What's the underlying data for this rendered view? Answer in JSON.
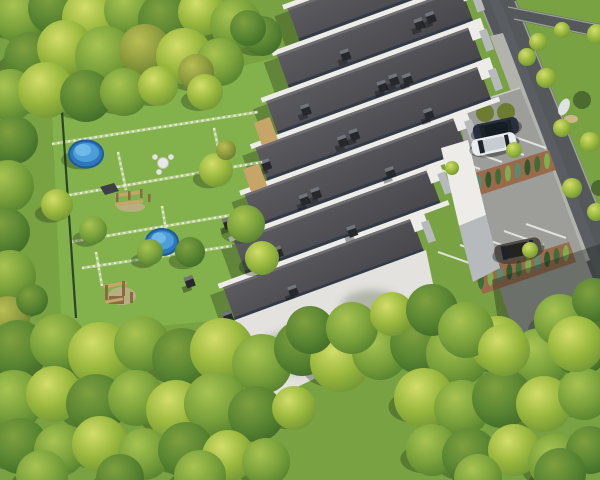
{
  "scene": {
    "type": "aerial-3d-architectural-render",
    "description": "Bird's-eye 3D visualization of a terraced housing development: seven staggered row-house units with dark flat roofs and white parapet walls descending diagonally, private gardens with white fences, two round above-ground pools, two wooden playgrounds, a diagonal asphalt road on the right with sidewalk and parking bays holding three cars, hedge planters between parking rows, surrounded by dense green tree canopy.",
    "counts": {
      "roof_rows": 7,
      "pools": 2,
      "playgrounds": 2,
      "cars": 3,
      "hedge_planters": 2,
      "roads": 2
    }
  },
  "colors": {
    "grass_base": "#79a342",
    "lawn": "#83b14c",
    "shadow": "rgba(24,42,18,0.32)",
    "road_asphalt": "#55585b",
    "road_lane": "#5e6165",
    "road_edge": "#9fa19b",
    "sidewalk": "#b2b3ac",
    "parking": "#9d9e9a",
    "parking_shadow": "rgba(28,36,30,0.38)",
    "stall_line": "#e8e9e4",
    "mulch": "#9a6a4b",
    "roof_parapet": "#333b48",
    "wall_white": "#edece8",
    "wall_shadow": "#b7babd",
    "facade": "#e3e2de",
    "chimney": "#26282c",
    "chimney_cap": "#72767c",
    "pool_rim": "#1d5b9a",
    "pool_wall": "#2f77bd",
    "pool_water": "#4c9ed8",
    "pool_light": "#79c2ec",
    "wood": "#c7a468",
    "wood_dark": "#8a6a45",
    "fence_white": "#e9ecd9",
    "fence_dark": "#2c4527",
    "hedge_ball": "#6d7c30",
    "sand": "#c2b089"
  },
  "scene_objects": {
    "trees": [
      [
        20,
        15,
        28,
        2
      ],
      [
        55,
        8,
        27,
        3
      ],
      [
        92,
        18,
        30,
        1
      ],
      [
        130,
        10,
        26,
        2
      ],
      [
        166,
        20,
        28,
        3
      ],
      [
        202,
        12,
        24,
        1
      ],
      [
        236,
        24,
        26,
        2
      ],
      [
        262,
        36,
        20,
        3
      ],
      [
        248,
        28,
        18,
        3
      ],
      [
        30,
        58,
        26,
        3
      ],
      [
        65,
        48,
        28,
        1
      ],
      [
        105,
        56,
        30,
        2
      ],
      [
        145,
        50,
        26,
        4
      ],
      [
        184,
        56,
        28,
        1
      ],
      [
        220,
        62,
        24,
        2
      ],
      [
        10,
        95,
        26,
        2
      ],
      [
        46,
        90,
        28,
        1
      ],
      [
        86,
        96,
        26,
        3
      ],
      [
        124,
        92,
        24,
        2
      ],
      [
        158,
        86,
        20,
        1
      ],
      [
        196,
        72,
        18,
        4
      ],
      [
        14,
        140,
        24,
        3
      ],
      [
        8,
        186,
        26,
        2
      ],
      [
        6,
        232,
        24,
        3
      ],
      [
        10,
        276,
        26,
        2
      ],
      [
        8,
        318,
        22,
        4
      ],
      [
        32,
        300,
        16,
        3
      ],
      [
        205,
        92,
        18,
        1
      ],
      [
        216,
        170,
        17,
        1
      ],
      [
        246,
        224,
        19,
        2
      ],
      [
        190,
        252,
        15,
        3
      ],
      [
        262,
        258,
        17,
        1
      ],
      [
        57,
        205,
        16,
        1
      ],
      [
        93,
        230,
        14,
        2
      ],
      [
        150,
        252,
        13,
        2
      ],
      [
        226,
        150,
        10,
        4
      ],
      [
        18,
        350,
        30,
        3
      ],
      [
        58,
        342,
        28,
        2
      ],
      [
        100,
        354,
        32,
        1
      ],
      [
        142,
        344,
        28,
        2
      ],
      [
        182,
        358,
        30,
        3
      ],
      [
        222,
        350,
        32,
        1
      ],
      [
        262,
        364,
        30,
        2
      ],
      [
        302,
        348,
        28,
        3
      ],
      [
        340,
        362,
        30,
        1
      ],
      [
        380,
        352,
        28,
        2
      ],
      [
        420,
        344,
        30,
        3
      ],
      [
        458,
        354,
        32,
        2
      ],
      [
        498,
        344,
        28,
        1
      ],
      [
        540,
        358,
        30,
        2
      ],
      [
        580,
        348,
        28,
        3
      ],
      [
        14,
        400,
        30,
        2
      ],
      [
        54,
        394,
        28,
        1
      ],
      [
        96,
        404,
        30,
        3
      ],
      [
        136,
        398,
        28,
        2
      ],
      [
        176,
        410,
        30,
        1
      ],
      [
        216,
        404,
        32,
        2
      ],
      [
        256,
        414,
        28,
        3
      ],
      [
        294,
        408,
        22,
        1
      ],
      [
        424,
        398,
        30,
        1
      ],
      [
        462,
        408,
        28,
        2
      ],
      [
        502,
        398,
        30,
        3
      ],
      [
        544,
        404,
        28,
        1
      ],
      [
        584,
        394,
        26,
        2
      ],
      [
        20,
        446,
        28,
        3
      ],
      [
        60,
        450,
        26,
        2
      ],
      [
        100,
        444,
        28,
        1
      ],
      [
        144,
        454,
        26,
        2
      ],
      [
        186,
        450,
        28,
        3
      ],
      [
        228,
        456,
        26,
        1
      ],
      [
        266,
        462,
        24,
        2
      ],
      [
        432,
        450,
        26,
        2
      ],
      [
        470,
        456,
        28,
        3
      ],
      [
        514,
        450,
        26,
        1
      ],
      [
        556,
        462,
        28,
        2
      ],
      [
        590,
        450,
        24,
        3
      ],
      [
        42,
        476,
        26,
        2
      ],
      [
        120,
        478,
        24,
        3
      ],
      [
        200,
        476,
        26,
        2
      ],
      [
        478,
        478,
        24,
        2
      ],
      [
        560,
        474,
        26,
        3
      ],
      [
        310,
        330,
        24,
        3
      ],
      [
        352,
        328,
        26,
        2
      ],
      [
        392,
        314,
        22,
        1
      ],
      [
        432,
        310,
        26,
        3
      ],
      [
        466,
        330,
        28,
        2
      ],
      [
        504,
        350,
        26,
        1
      ],
      [
        560,
        320,
        26,
        2
      ],
      [
        594,
        300,
        22,
        3
      ],
      [
        576,
        344,
        28,
        1
      ]
    ],
    "bushes": [
      [
        527,
        57,
        9
      ],
      [
        546,
        78,
        10
      ],
      [
        562,
        128,
        9
      ],
      [
        590,
        142,
        10
      ],
      [
        572,
        188,
        10
      ],
      [
        596,
        212,
        9
      ],
      [
        538,
        42,
        9
      ],
      [
        562,
        30,
        8
      ],
      [
        514,
        150,
        8
      ],
      [
        530,
        250,
        8
      ],
      [
        597,
        34,
        10
      ],
      [
        452,
        168,
        7
      ]
    ],
    "dark_bushes": [
      [
        582,
        100,
        9
      ],
      [
        599,
        188,
        8
      ]
    ],
    "building": {
      "rows": [
        {
          "x": 40,
          "w": 225,
          "y": 0,
          "ch": [
            [
              150,
              8
            ],
            [
              163,
              6
            ],
            [
              176,
              10
            ]
          ]
        },
        {
          "x": 14,
          "w": 196,
          "y": 40,
          "ch": [
            [
              60,
              18
            ],
            [
              140,
              14
            ],
            [
              153,
              12
            ]
          ]
        },
        {
          "x": -12,
          "w": 217,
          "y": 80,
          "ch": [
            [
              30,
              16
            ],
            [
              110,
              20
            ],
            [
              123,
              18
            ],
            [
              136,
              22
            ]
          ]
        },
        {
          "x": -38,
          "w": 238,
          "y": 120,
          "ch": [
            [
              0,
              14
            ],
            [
              80,
              18
            ],
            [
              93,
              16
            ],
            [
              170,
              22
            ]
          ]
        },
        {
          "x": -64,
          "w": 224,
          "y": 160,
          "ch": [
            [
              -30,
              16
            ],
            [
              50,
              20
            ],
            [
              63,
              18
            ],
            [
              140,
              24
            ]
          ]
        },
        {
          "x": -90,
          "w": 207,
          "y": 200,
          "ch": [
            [
              -60,
              18
            ],
            [
              20,
              22
            ],
            [
              33,
              20
            ],
            [
              110,
              26
            ]
          ]
        },
        {
          "x": -116,
          "w": 201,
          "y": 240,
          "ch": [
            [
              -86,
              20
            ],
            [
              -10,
              24
            ],
            [
              60,
              22
            ]
          ]
        }
      ],
      "strips": [
        [
          36,
          -5,
          233
        ],
        [
          10,
          35,
          263
        ],
        [
          -16,
          75,
          234
        ],
        [
          -42,
          115,
          255
        ],
        [
          -68,
          155,
          276
        ],
        [
          -94,
          195,
          262
        ],
        [
          -120,
          235,
          245
        ]
      ],
      "patios": [
        [
          -31,
          96
        ],
        [
          -57,
          136
        ]
      ]
    },
    "fences": {
      "white": [
        [
          52,
          144,
          258,
          112
        ],
        [
          64,
          196,
          262,
          162
        ],
        [
          70,
          242,
          238,
          214
        ],
        [
          82,
          268,
          232,
          246
        ],
        [
          214,
          128,
          222,
          166
        ],
        [
          118,
          152,
          126,
          190
        ],
        [
          162,
          206,
          168,
          242
        ],
        [
          96,
          252,
          102,
          286
        ]
      ],
      "dark": [
        62,
        112,
        76,
        318
      ]
    },
    "parking": {
      "stalls": [
        [
          458,
          176
        ],
        [
          480,
          169
        ],
        [
          502,
          162
        ],
        [
          524,
          155
        ],
        [
          546,
          148
        ],
        [
          478,
          266
        ],
        [
          500,
          259
        ],
        [
          522,
          252
        ],
        [
          544,
          245
        ],
        [
          566,
          238
        ]
      ],
      "planters": [
        {
          "poly": "452,180 549,150 556,170 459,202",
          "a": [
            459,
            189
          ],
          "b": [
            547,
            161
          ],
          "n": 10
        },
        {
          "poly": "472,272 569,242 576,262 483,294",
          "a": [
            481,
            281
          ],
          "b": [
            566,
            253
          ],
          "n": 10
        }
      ],
      "hedges_round": [
        [
          485,
          113,
          9
        ],
        [
          506,
          112,
          9
        ]
      ]
    },
    "cars": [
      {
        "name": "car-dark-suv",
        "cx": 496,
        "cy": 129,
        "rot": -12,
        "len": 46,
        "wid": 17,
        "body": "#27303c",
        "roof": "#161c24"
      },
      {
        "name": "car-white-hatchback",
        "cx": 494,
        "cy": 144,
        "rot": -12,
        "len": 45,
        "wid": 17,
        "body": "#e9edef",
        "roof": "#c6ccd1"
      },
      {
        "name": "car-bronze-suv",
        "cx": 518,
        "cy": 250,
        "rot": -12,
        "len": 47,
        "wid": 18,
        "body": "#514c45",
        "roof": "#24231f"
      }
    ],
    "pools": [
      {
        "cx": 86,
        "cy": 154,
        "rx": 17,
        "ry": 13.5
      },
      {
        "cx": 162,
        "cy": 242,
        "rx": 16,
        "ry": 13
      }
    ],
    "playgrounds": [
      {
        "roof": "100,187 114,183 119,191 105,195",
        "beams": [
          [
            115,
            192,
            28,
            3.5,
            -8,
            129,
            194
          ],
          [
            115,
            201,
            28,
            3.5,
            -8,
            129,
            203
          ]
        ],
        "posts": [
          [
            116,
            193,
            2.5,
            9
          ],
          [
            128,
            191,
            2.5,
            9
          ],
          [
            140,
            189,
            2.5,
            9
          ],
          [
            148,
            194,
            2.5,
            8
          ]
        ],
        "ground": [
          131,
          207,
          14,
          5
        ]
      },
      {
        "roof": "",
        "beams": [
          [
            103,
            283,
            24,
            3.5,
            -10,
            115,
            285
          ],
          [
            105,
            299,
            18,
            3,
            -10,
            114,
            300
          ]
        ],
        "posts": [
          [
            105,
            285,
            3,
            15
          ],
          [
            122,
            281,
            3,
            15
          ],
          [
            130,
            292,
            3,
            11
          ]
        ],
        "ground": [
          122,
          296,
          14,
          9
        ],
        "platform": [
          109,
          296,
          15,
          8
        ]
      }
    ],
    "furniture": {
      "table": [
        163,
        163,
        5.5
      ],
      "chairs": [
        [
          155,
          157
        ],
        [
          171,
          157
        ],
        [
          159,
          172
        ]
      ]
    },
    "white_object": {
      "tarp": [
        564,
        107,
        5,
        9
      ],
      "base": [
        571,
        119,
        7,
        4
      ]
    },
    "facade_shadows": [
      [
        300,
        352,
        42,
        22
      ],
      [
        372,
        306,
        30,
        16
      ]
    ]
  }
}
